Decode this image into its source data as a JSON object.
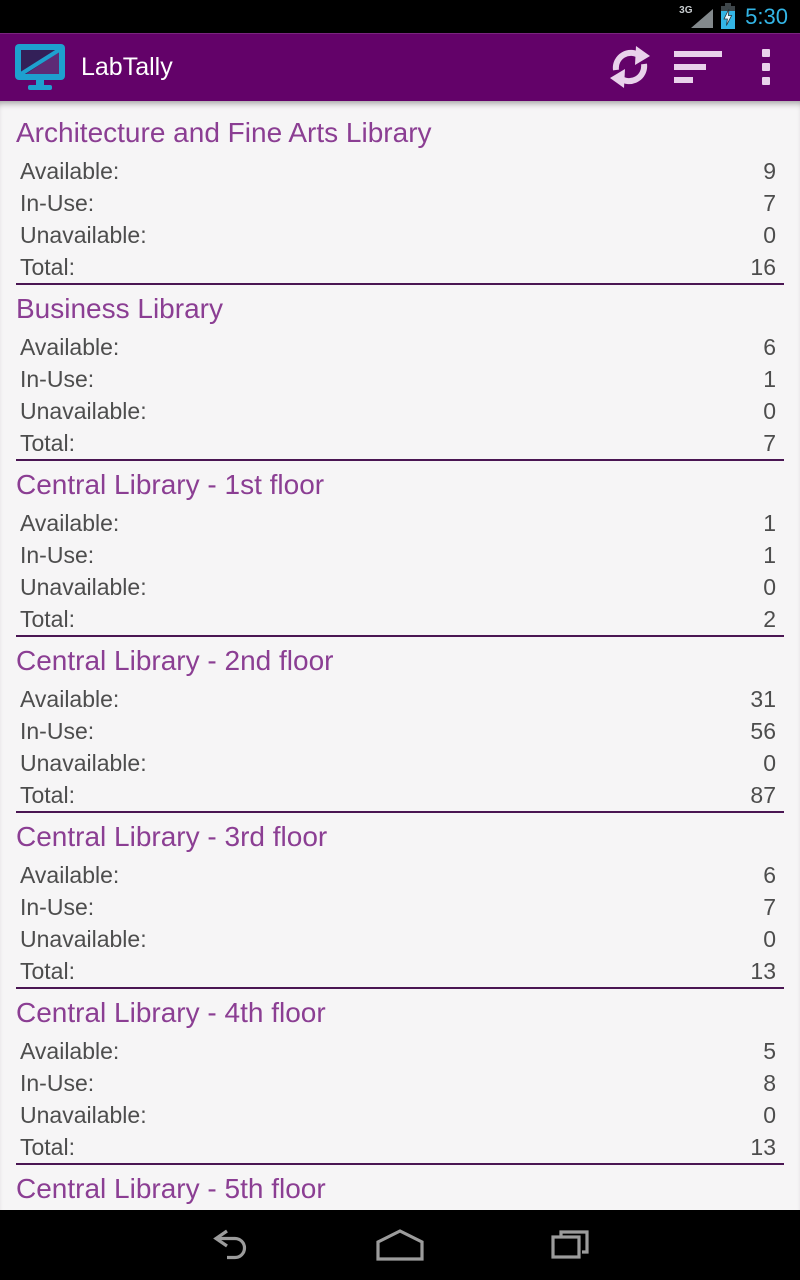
{
  "status_bar": {
    "network": "3G",
    "time": "5:30",
    "icons": [
      "signal-triangle-icon",
      "battery-charging-icon"
    ]
  },
  "action_bar": {
    "title": "LabTally",
    "icons": [
      "app-monitor-icon",
      "refresh-icon",
      "sort-icon",
      "overflow-menu-icon"
    ]
  },
  "row_labels": {
    "available": "Available:",
    "in_use": "In-Use:",
    "unavailable": "Unavailable:",
    "total": "Total:"
  },
  "sections": [
    {
      "title": "Architecture and Fine Arts Library",
      "values": {
        "available": 9,
        "in_use": 7,
        "unavailable": 0,
        "total": 16
      }
    },
    {
      "title": "Business Library",
      "values": {
        "available": 6,
        "in_use": 1,
        "unavailable": 0,
        "total": 7
      }
    },
    {
      "title": "Central Library - 1st floor",
      "values": {
        "available": 1,
        "in_use": 1,
        "unavailable": 0,
        "total": 2
      }
    },
    {
      "title": "Central Library - 2nd floor",
      "values": {
        "available": 31,
        "in_use": 56,
        "unavailable": 0,
        "total": 87
      }
    },
    {
      "title": "Central Library - 3rd floor",
      "values": {
        "available": 6,
        "in_use": 7,
        "unavailable": 0,
        "total": 13
      }
    },
    {
      "title": "Central Library - 4th floor",
      "values": {
        "available": 5,
        "in_use": 8,
        "unavailable": 0,
        "total": 13
      }
    },
    {
      "title": "Central Library - 5th floor"
    }
  ],
  "nav_bar": {
    "icons": [
      "back-icon",
      "home-icon",
      "recents-icon"
    ]
  },
  "colors": {
    "action_bar_bg": "#630269",
    "section_title": "#8B3E93",
    "divider": "#4A1653",
    "row_text": "#4D4D4D",
    "status_time": "#33B5E5",
    "app_icon_cyan": "#1EA0CF",
    "actionbar_icon": "#E9D2EB",
    "content_bg": "#F6F5F6"
  }
}
